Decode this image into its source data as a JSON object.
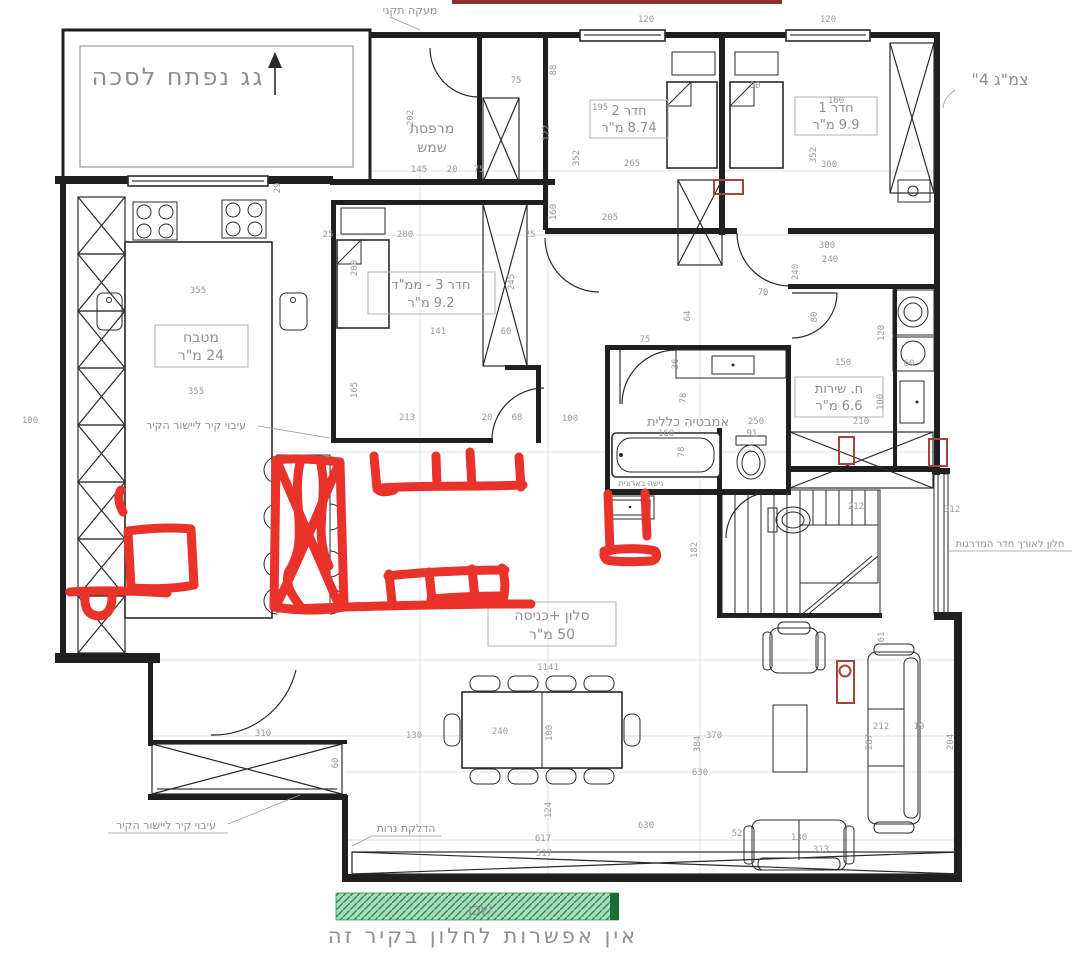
{
  "colors": {
    "marker_red": "#e8322a",
    "outline_red": "#a8423a",
    "topline_red": "#8e2f2f",
    "green_fill": "#a9dcbd",
    "green_hatch": "#2e8b57",
    "green_dark": "#1d6b38",
    "text_gray": "#8f8f8f",
    "wall_black": "#1f1f1f"
  },
  "labels": {
    "roof_note": "גג נפתח לסכה",
    "railing_note": "מעקה תקני",
    "balcony_line1": "מרפסת",
    "balcony_line2": "שמש",
    "room2_name": "חדר 2",
    "room2_area": "8.74 מ\"ר",
    "room1_name": "חדר 1",
    "room1_area": "9.9 מ\"ר",
    "room3_name": "חדר 3 - ממ\"ד",
    "room3_area": "9.2 מ\"ר",
    "kitchen_name": "מטבח",
    "kitchen_area": "24 מ\"ר",
    "bath_name": "אמבטיה כללית",
    "service_name": "ח. שירות",
    "service_area": "6.6 מ\"ר",
    "salon_name": "סלון +כניסה",
    "salon_area": "50 מ\"ר",
    "wall_note": "עיבוי קיר ליישור הקיר",
    "candles_note": "הדלקת נרות",
    "stair_window_note": "חלון לאורך חדר המדרגות",
    "pipe_note": "צמ\"ג 4\"",
    "niche_note": "נישה בארונית",
    "neighbor": "שכן",
    "no_window_note": "אין אפשרות לחלון בקיר זה"
  },
  "dimensions": [
    {
      "v": "120",
      "x": 646,
      "y": 22
    },
    {
      "v": "120",
      "x": 828,
      "y": 22
    },
    {
      "v": "90",
      "x": 755,
      "y": 88
    },
    {
      "v": "195",
      "x": 600,
      "y": 110
    },
    {
      "v": "160",
      "x": 836,
      "y": 103
    },
    {
      "v": "75",
      "x": 516,
      "y": 83
    },
    {
      "v": "88",
      "x": 556,
      "y": 70,
      "r": 1
    },
    {
      "v": "202",
      "x": 413,
      "y": 118,
      "r": 1
    },
    {
      "v": "122",
      "x": 549,
      "y": 133,
      "r": 1
    },
    {
      "v": "352",
      "x": 579,
      "y": 158,
      "r": 1
    },
    {
      "v": "352",
      "x": 816,
      "y": 155,
      "r": 1
    },
    {
      "v": "300",
      "x": 829,
      "y": 167
    },
    {
      "v": "145",
      "x": 419,
      "y": 172
    },
    {
      "v": "20",
      "x": 452,
      "y": 172
    },
    {
      "v": "75",
      "x": 479,
      "y": 172
    },
    {
      "v": "265",
      "x": 632,
      "y": 166
    },
    {
      "v": "205",
      "x": 610,
      "y": 220
    },
    {
      "v": "280",
      "x": 405,
      "y": 237
    },
    {
      "v": "25",
      "x": 328,
      "y": 237
    },
    {
      "v": "25",
      "x": 530,
      "y": 237
    },
    {
      "v": "160",
      "x": 556,
      "y": 212,
      "r": 1
    },
    {
      "v": "200",
      "x": 357,
      "y": 268,
      "r": 1
    },
    {
      "v": "300",
      "x": 827,
      "y": 248
    },
    {
      "v": "240",
      "x": 830,
      "y": 262
    },
    {
      "v": "245",
      "x": 514,
      "y": 282,
      "r": 1
    },
    {
      "v": "141",
      "x": 438,
      "y": 334
    },
    {
      "v": "60",
      "x": 506,
      "y": 334
    },
    {
      "v": "70",
      "x": 763,
      "y": 295
    },
    {
      "v": "64",
      "x": 690,
      "y": 316,
      "r": 1
    },
    {
      "v": "80",
      "x": 817,
      "y": 317,
      "r": 1
    },
    {
      "v": "240",
      "x": 798,
      "y": 272,
      "r": 1
    },
    {
      "v": "75",
      "x": 645,
      "y": 342
    },
    {
      "v": "36",
      "x": 678,
      "y": 364,
      "r": 1
    },
    {
      "v": "165",
      "x": 357,
      "y": 390,
      "r": 1
    },
    {
      "v": "78",
      "x": 686,
      "y": 398,
      "r": 1
    },
    {
      "v": "150",
      "x": 843,
      "y": 365
    },
    {
      "v": "120",
      "x": 884,
      "y": 333,
      "r": 1
    },
    {
      "v": "60",
      "x": 909,
      "y": 366
    },
    {
      "v": "100",
      "x": 883,
      "y": 402,
      "r": 1
    },
    {
      "v": "100",
      "x": 570,
      "y": 421
    },
    {
      "v": "250",
      "x": 756,
      "y": 424
    },
    {
      "v": "210",
      "x": 861,
      "y": 424
    },
    {
      "v": "160",
      "x": 666,
      "y": 436
    },
    {
      "v": "91",
      "x": 752,
      "y": 436
    },
    {
      "v": "78",
      "x": 684,
      "y": 452,
      "r": 1
    },
    {
      "v": "213",
      "x": 407,
      "y": 420
    },
    {
      "v": "20",
      "x": 487,
      "y": 420
    },
    {
      "v": "68",
      "x": 517,
      "y": 420
    },
    {
      "v": "100",
      "x": 30,
      "y": 423
    },
    {
      "v": "355",
      "x": 198,
      "y": 293
    },
    {
      "v": "355",
      "x": 196,
      "y": 394
    },
    {
      "v": "29",
      "x": 280,
      "y": 188,
      "r": 1
    },
    {
      "v": "182",
      "x": 697,
      "y": 550,
      "r": 1
    },
    {
      "v": "212",
      "x": 856,
      "y": 509
    },
    {
      "v": "312",
      "x": 952,
      "y": 512
    },
    {
      "v": "61",
      "x": 884,
      "y": 637,
      "r": 1
    },
    {
      "v": "310",
      "x": 263,
      "y": 736
    },
    {
      "v": "60",
      "x": 338,
      "y": 763,
      "r": 1
    },
    {
      "v": "1141",
      "x": 548,
      "y": 670
    },
    {
      "v": "240",
      "x": 500,
      "y": 734
    },
    {
      "v": "100",
      "x": 552,
      "y": 733,
      "r": 1
    },
    {
      "v": "130",
      "x": 414,
      "y": 738
    },
    {
      "v": "370",
      "x": 714,
      "y": 738
    },
    {
      "v": "384",
      "x": 700,
      "y": 744,
      "r": 1
    },
    {
      "v": "630",
      "x": 700,
      "y": 775
    },
    {
      "v": "287",
      "x": 872,
      "y": 742,
      "r": 1
    },
    {
      "v": "212",
      "x": 881,
      "y": 729
    },
    {
      "v": "19",
      "x": 919,
      "y": 729
    },
    {
      "v": "204",
      "x": 953,
      "y": 742,
      "r": 1
    },
    {
      "v": "124",
      "x": 551,
      "y": 810,
      "r": 1
    },
    {
      "v": "630",
      "x": 646,
      "y": 828
    },
    {
      "v": "617",
      "x": 543,
      "y": 841
    },
    {
      "v": "52",
      "x": 737,
      "y": 836
    },
    {
      "v": "517",
      "x": 544,
      "y": 856
    },
    {
      "v": "130",
      "x": 799,
      "y": 840
    },
    {
      "v": "313",
      "x": 821,
      "y": 852
    }
  ]
}
